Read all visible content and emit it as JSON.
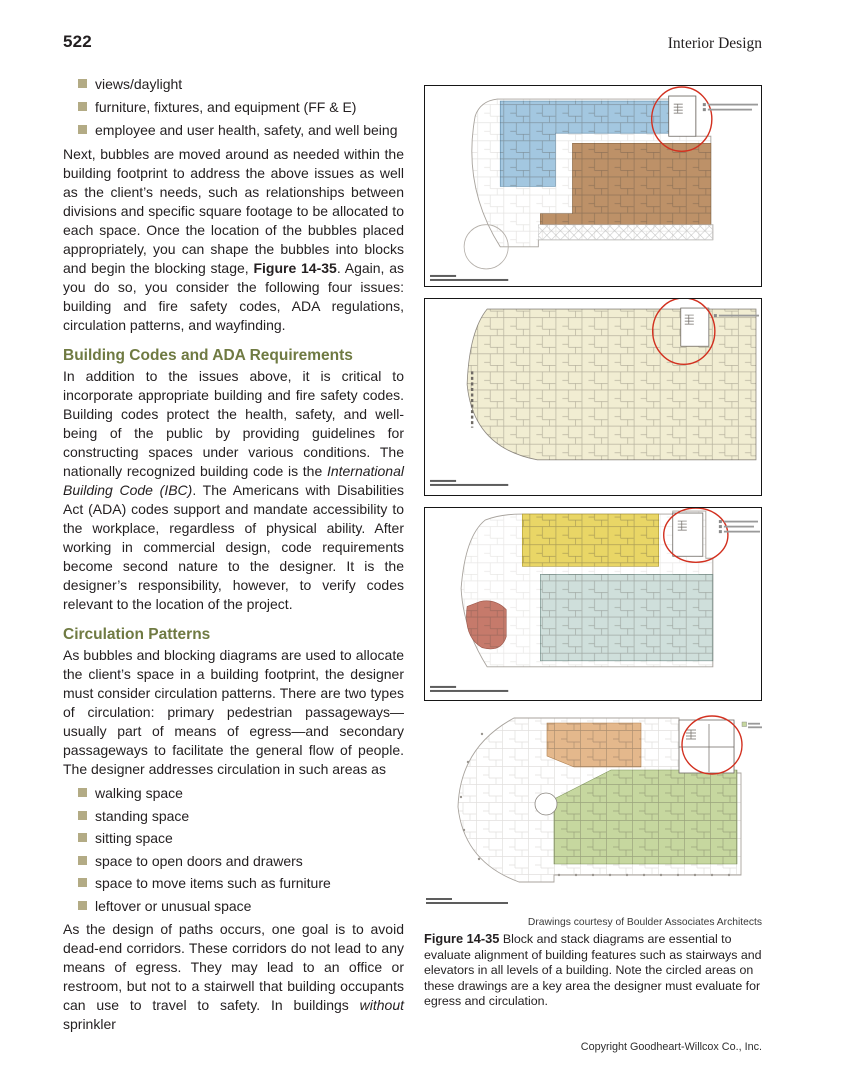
{
  "page": {
    "number": "522",
    "running_head": "Interior Design",
    "copyright": "Copyright Goodheart-Willcox Co., Inc."
  },
  "article": {
    "intro_bullets": [
      "views/daylight",
      "furniture, fixtures, and equipment (FF & E)",
      "employee and user health, safety, and well being"
    ],
    "para1": {
      "pre": "Next, bubbles are moved around as needed within the building footprint to address the above issues as well as the client’s needs, such as relationships between divisions and specific square footage to be allocated to each space. Once the location of the bubbles placed appropriately, you can shape the bubbles into blocks and begin the blocking stage, ",
      "bold": "Figure 14-35",
      "post": ". Again, as you do so, you consider the following four issues: building and fire safety codes, ADA regulations, circulation patterns, and wayfinding."
    },
    "section1": {
      "heading": "Building Codes and ADA Requirements",
      "para": {
        "pre": "In addition to the issues above, it is critical to incorporate appropriate building and fire safety codes. Building codes protect the health, safety, and well-being of the public by providing guidelines for constructing spaces under various conditions. The nationally recognized building code is the ",
        "italic": "International Building Code (IBC)",
        "post": ". The Americans with Disabilities Act (ADA) codes support and mandate accessibility to the workplace, regardless of physical ability. After working in commercial design, code requirements become second nature to the designer. It is the designer’s responsibility, however, to verify codes relevant to the location of the project."
      }
    },
    "section2": {
      "heading": "Circulation Patterns",
      "para": "As bubbles and blocking diagrams are used to allocate the client’s space in a building footprint, the designer must consider circulation patterns. There are two types of circulation: primary pedestrian passageways—usually part of means of egress—and secondary passageways to facilitate the general flow of people. The designer addresses circulation in such areas as"
    },
    "circulation_bullets": [
      "walking space",
      "standing space",
      "sitting space",
      "space to open doors and drawers",
      "space to move items such as furniture",
      "leftover or unusual space"
    ],
    "para_close": {
      "pre": "As the design of paths occurs, one goal is to avoid dead-end corridors. These corridors do not lead to any means of egress. They may lead to an office or restroom, but not to a stairwell that building occupants can use to travel to safety. In buildings ",
      "italic": "without",
      "post": " sprinkler"
    }
  },
  "figure": {
    "credit": "Drawings courtesy of Boulder Associates Architects",
    "label": "Figure 14-35",
    "caption": " Block and stack diagrams are essential to evaluate alignment of building features such as stairways and elevators in all levels of a building. Note the circled areas on these drawings are a key area the designer must evaluate for egress and circulation.",
    "annotation_color": "#d2301f",
    "panels": [
      {
        "name": "block-stack-plan-top",
        "fills": {
          "blue": "#a3c7e0",
          "brown": "#bd9168"
        }
      },
      {
        "name": "block-stack-plan-second",
        "fills": {
          "cream": "#f1edd2"
        }
      },
      {
        "name": "block-stack-plan-third",
        "fills": {
          "yellow": "#e9d666",
          "teal": "#cfdfdb",
          "salmon": "#c67a6b"
        }
      },
      {
        "name": "block-stack-plan-ground",
        "fills": {
          "orange": "#e4b88c",
          "green": "#c6d79f"
        }
      }
    ]
  },
  "ui_colors": {
    "section_heading": "#6f7a42",
    "bullet_square": "#b3ab85"
  }
}
